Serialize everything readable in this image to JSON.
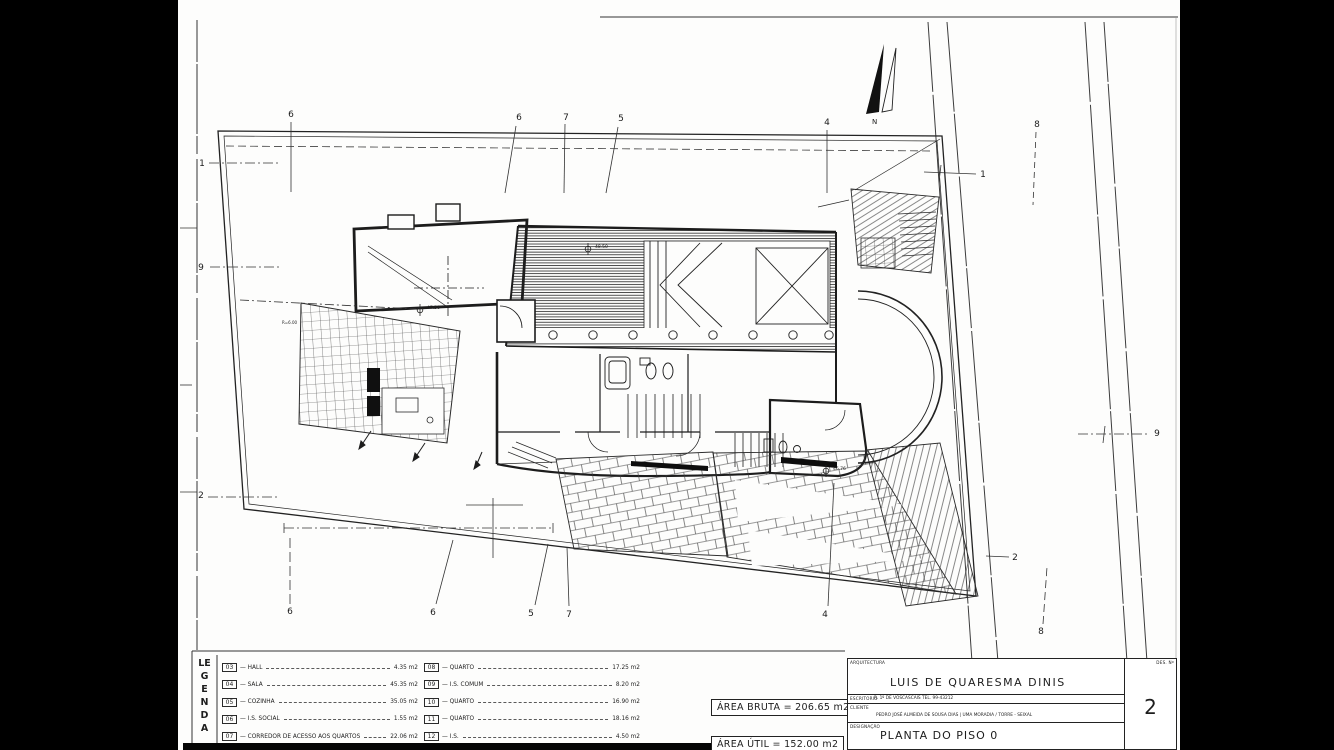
{
  "colors": {
    "ink": "#1d1d1d",
    "paper": "#fdfdfc",
    "matte": "#000000"
  },
  "drawing": {
    "north_label": "N",
    "markers": {
      "t1": "6",
      "t2": "6",
      "t3": "7",
      "t4": "5",
      "t5": "4",
      "t6": "8",
      "b1": "6",
      "b2": "6",
      "b3": "5",
      "b4": "7",
      "b5": "4",
      "b6": "8",
      "l1": "1",
      "l2": "9",
      "l3": "2",
      "r1": "1",
      "r2": "9",
      "r3": "2"
    },
    "levels": {
      "a": "47.56",
      "b": "48.50",
      "c": "46.76",
      "radius_note": "R=6.00"
    }
  },
  "legend": {
    "title": "LEGENDA",
    "left": [
      {
        "code": "03",
        "label": "HALL",
        "area": "4.35 m2"
      },
      {
        "code": "04",
        "label": "SALA",
        "area": "45.35 m2"
      },
      {
        "code": "05",
        "label": "COZINHA",
        "area": "35.05 m2"
      },
      {
        "code": "06",
        "label": "I.S. SOCIAL",
        "area": "1.55 m2"
      },
      {
        "code": "07",
        "label": "CORREDOR DE ACESSO AOS QUARTOS",
        "area": "22.06 m2"
      }
    ],
    "right": [
      {
        "code": "08",
        "label": "QUARTO",
        "area": "17.25 m2"
      },
      {
        "code": "09",
        "label": "I.S. COMUM",
        "area": "8.20 m2"
      },
      {
        "code": "10",
        "label": "QUARTO",
        "area": "16.90 m2"
      },
      {
        "code": "11",
        "label": "QUARTO",
        "area": "18.16 m2"
      },
      {
        "code": "12",
        "label": "I.S.",
        "area": "4.50 m2"
      }
    ]
  },
  "areas": {
    "bruta": "ÁREA BRUTA = 206.65 m2",
    "util": "ÁREA ÚTIL = 152.00 m2"
  },
  "titleblock": {
    "arquitectura_label": "ARQUITECTURA",
    "architect": "LUIS DE QUARESMA DINIS",
    "escritorio_label": "ESCRITORIO",
    "escritorio": "R. 1º DE VOSCASCAIS   TEL. 99-43212",
    "cliente_label": "CLIENTE",
    "cliente": "PEDRO JOSÉ ALMEIDA DE SOUSA DIAS | UMA MORADIA / TORRE - SEIXAL",
    "designacao_label": "DESIGNAÇÃO",
    "designacao": "PLANTA DO PISO 0",
    "des_no_label": "DES. Nº",
    "sheet_number": "2"
  }
}
